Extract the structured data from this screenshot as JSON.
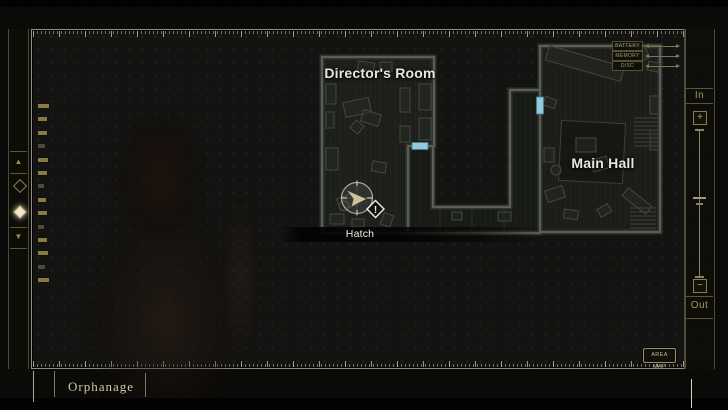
{
  "map": {
    "rooms": [
      {
        "name": "Director's Room"
      },
      {
        "name": "Main Hall"
      }
    ],
    "marker": {
      "label": "Hatch",
      "alert_symbol": "!"
    },
    "door_color": "#8fcbdb"
  },
  "legend": {
    "items": [
      {
        "label": "BATTERY"
      },
      {
        "label": "MEMORY"
      },
      {
        "label": "DISC"
      }
    ]
  },
  "left_rail": {
    "up_symbol": "▲",
    "down_symbol": "▼",
    "marks": [
      {
        "w": 11,
        "b": 1
      },
      {
        "w": 9,
        "b": 1
      },
      {
        "w": 9,
        "b": 1
      },
      {
        "w": 7,
        "b": 0
      },
      {
        "w": 10,
        "b": 1
      },
      {
        "w": 9,
        "b": 1
      },
      {
        "w": 6,
        "b": 0
      },
      {
        "w": 8,
        "b": 1
      },
      {
        "w": 9,
        "b": 1
      },
      {
        "w": 6,
        "b": 0
      },
      {
        "w": 9,
        "b": 1
      },
      {
        "w": 10,
        "b": 1
      },
      {
        "w": 7,
        "b": 0
      },
      {
        "w": 11,
        "b": 1
      }
    ]
  },
  "right_rail": {
    "in_label": "In",
    "out_label": "Out",
    "zoom_in_symbol": "+",
    "zoom_out_symbol": "−"
  },
  "footer": {
    "area_name": "Orphanage",
    "area_map_button": "AREA MAP"
  }
}
